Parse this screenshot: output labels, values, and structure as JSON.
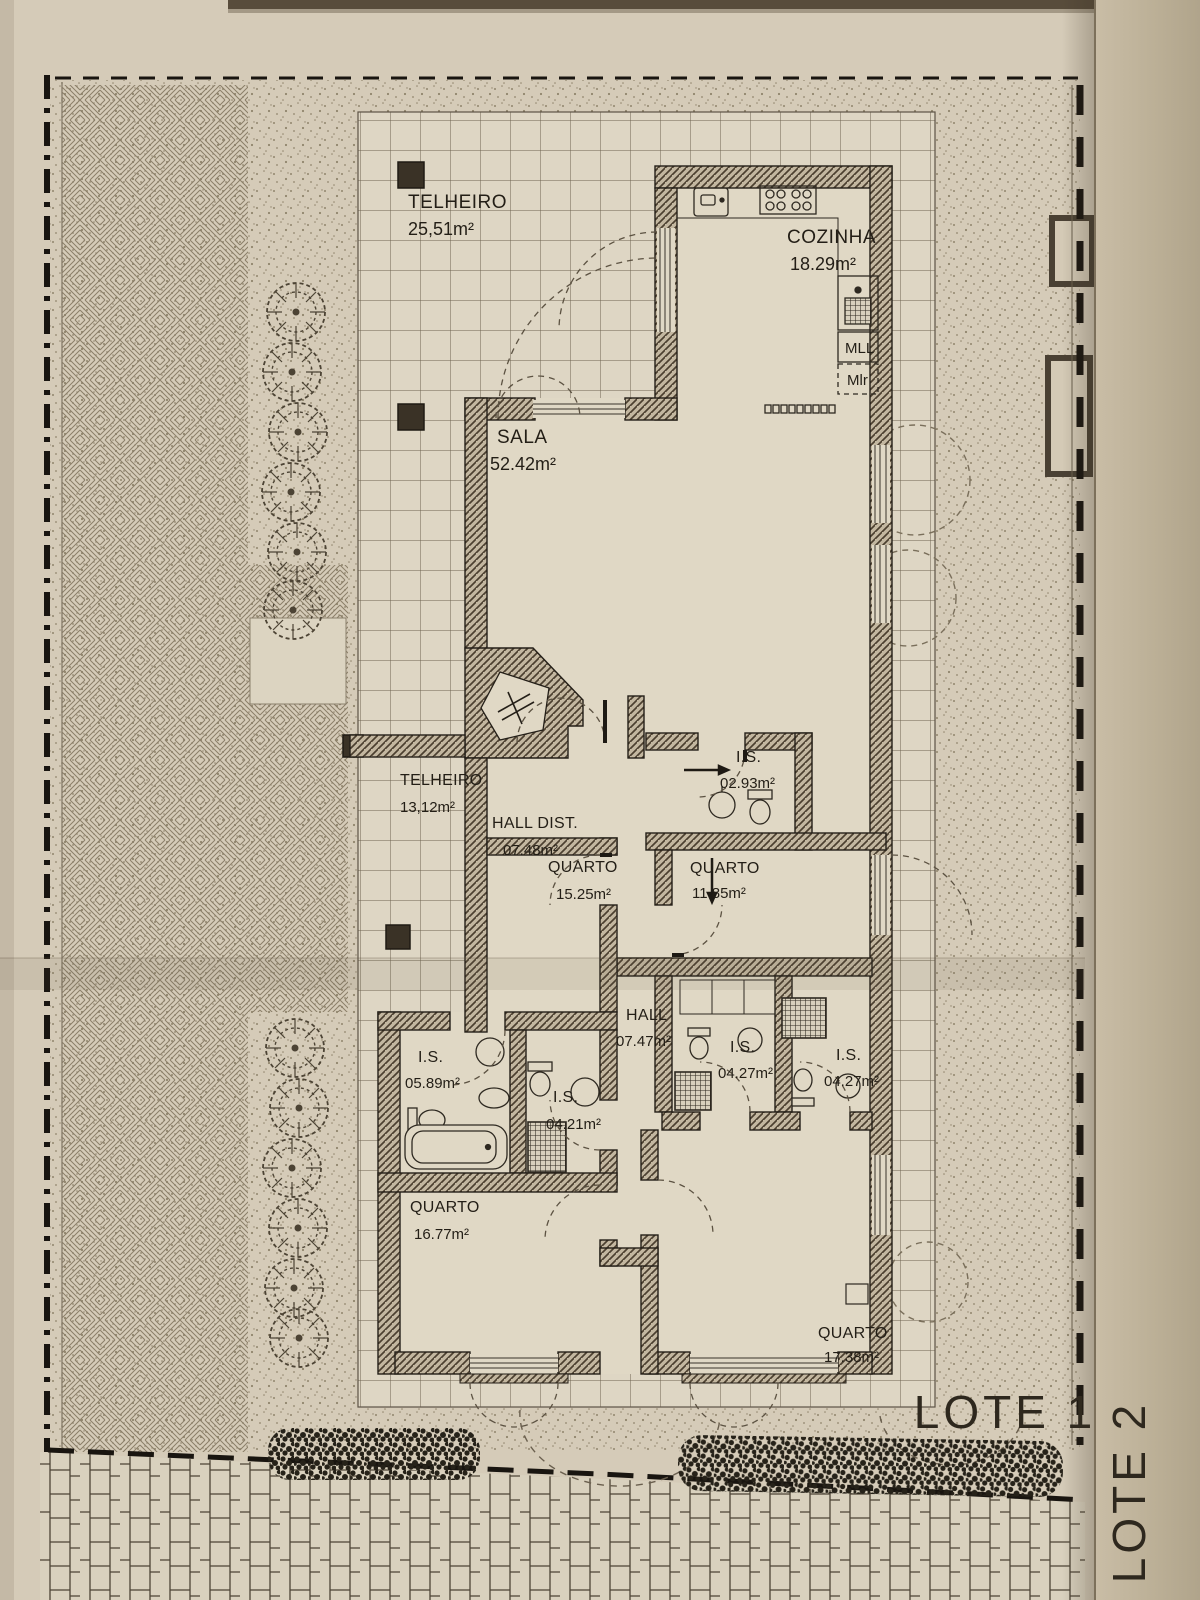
{
  "sheet": {
    "lot_label_1": "LOTE 1",
    "lot_label_2": "LOTE 2"
  },
  "rooms": [
    {
      "id": "telheiro-grande",
      "name": "TELHEIRO",
      "area": "25,51m²"
    },
    {
      "id": "cozinha",
      "name": "COZINHA",
      "area": "18.29m²"
    },
    {
      "id": "sala",
      "name": "SALA",
      "area": "52.42m²"
    },
    {
      "id": "telheiro-pequeno",
      "name": "TELHEIRO",
      "area": "13,12m²"
    },
    {
      "id": "hall-dist",
      "name": "HALL DIST.",
      "area": "07.48m²"
    },
    {
      "id": "quarto-1",
      "name": "QUARTO",
      "area": "15.25m²"
    },
    {
      "id": "is-1",
      "name": "I.S.",
      "area": "02.93m²"
    },
    {
      "id": "quarto-2",
      "name": "QUARTO",
      "area": "11.85m²"
    },
    {
      "id": "hall",
      "name": "HALL",
      "area": "07.47m²"
    },
    {
      "id": "is-2",
      "name": "I.S.",
      "area": "05.89m²"
    },
    {
      "id": "is-3",
      "name": "I.S.",
      "area": "04.21m²"
    },
    {
      "id": "is-4",
      "name": "I.S.",
      "area": "04.27m²"
    },
    {
      "id": "is-5",
      "name": "I.S.",
      "area": "04.27m²"
    },
    {
      "id": "quarto-3",
      "name": "QUARTO",
      "area": "16.77m²"
    },
    {
      "id": "quarto-4",
      "name": "QUARTO",
      "area": "17.38m²"
    }
  ],
  "appliances": {
    "washer": "MLL",
    "dryer": "Mlr"
  }
}
